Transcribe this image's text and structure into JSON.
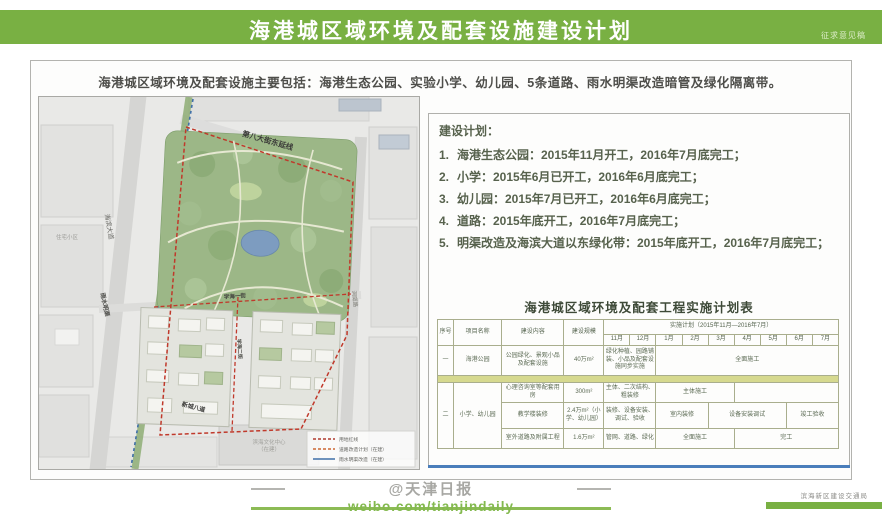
{
  "header": {
    "title": "海港城区域环境及配套设施建设计划",
    "corner_note": "征求意见稿",
    "accent_green": "#79b043"
  },
  "summary": {
    "text": "海港城区域环境及配套设施主要包括：海港生态公园、实验小学、幼儿园、5条道路、雨水明渠改造暗管及绿化隔离带。"
  },
  "map": {
    "road_label_top": "第八大街东延线",
    "road_label_left": "海滨大道",
    "channel_label": "雨水明渠",
    "road_label_mid": "学海一街",
    "road_label_mid_vertical": "学海二街",
    "road_label_bottom": "新城八道",
    "road_label_right": "洞庭路",
    "district_label": "住宅小区",
    "area_label_line1": "滨海文化中心",
    "area_label_line2": "（在建）",
    "legend": [
      {
        "label": "用地红线",
        "style": "dashed",
        "color": "#b03a2e"
      },
      {
        "label": "道路改造计划（在建）",
        "style": "dashed",
        "color": "#cc6633"
      },
      {
        "label": "雨水明渠改造（在建）",
        "style": "solid",
        "color": "#3f6fa8"
      }
    ]
  },
  "plan": {
    "heading": "建设计划：",
    "items": [
      {
        "num": "1.",
        "text": "海港生态公园：2015年11月开工，2016年7月底完工；"
      },
      {
        "num": "2.",
        "text": "小学：2015年6月已开工，2016年6月底完工；"
      },
      {
        "num": "3.",
        "text": "幼儿园：2015年7月已开工，2016年6月底完工；"
      },
      {
        "num": "4.",
        "text": "道路：2015年底开工，2016年7月底完工；"
      },
      {
        "num": "5.",
        "text": "明渠改造及海滨大道以东绿化带：2015年底开工，2016年7月底完工；"
      }
    ]
  },
  "table": {
    "title": "海港城区域环境及配套工程实施计划表",
    "col_seq": "序号",
    "col_name": "项目名称",
    "col_content": "建设内容",
    "col_scale": "建设规模",
    "col_plan": "实施计划（2015年11月—2016年7月）",
    "months": [
      "11月",
      "12月",
      "1月",
      "2月",
      "3月",
      "4月",
      "5月",
      "6月",
      "7月"
    ],
    "row1": {
      "seq": "一",
      "name": "海港公园",
      "content": "公园绿化、景观小品及配套设施",
      "scale": "40万m²",
      "note": "绿化种植、园路铺装、小品及配套设施同步实施",
      "bar": "全面施工"
    },
    "group": {
      "seq": "二",
      "name": "小学、幼儿园",
      "rows": [
        {
          "content": "心理咨询室等配套用房",
          "scale": "300m²",
          "note": "主体、二次结构、粗装修",
          "bar1": "主体施工",
          "bar2": ""
        },
        {
          "content": "教学楼装修",
          "scale": "2.4万m²（小学、幼儿园）",
          "note": "装修、设备安装、调试、验收",
          "bar1": "室内装修",
          "bar2": "设备安装调试",
          "bar3": "竣工验收"
        },
        {
          "content": "室外道路及附属工程",
          "scale": "1.6万m²",
          "note": "管网、道路、绿化",
          "bar1": "全面施工",
          "bar2": "完工"
        }
      ]
    }
  },
  "footer": {
    "watermark": "@天津日报",
    "weibo": "weibo.com/tianjindaily",
    "agency": "滨海新区建设交通局"
  }
}
